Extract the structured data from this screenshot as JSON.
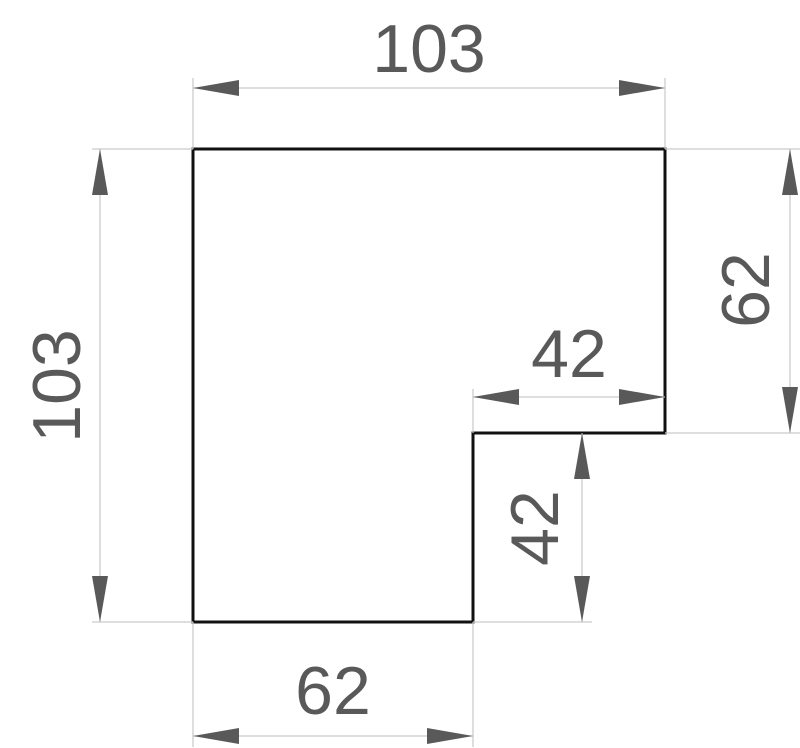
{
  "drawing": {
    "title": "l-shaped-part-technical-drawing",
    "colors": {
      "background": "#ffffff",
      "outline": "#111111",
      "dimension_line": "#c9c9c9",
      "dimension_text": "#595959",
      "arrowhead": "#595959"
    },
    "dimensions": {
      "top_width": "103",
      "left_height": "103",
      "right_height": "62",
      "notch_width": "42",
      "notch_height": "42",
      "bottom_width": "62"
    }
  }
}
